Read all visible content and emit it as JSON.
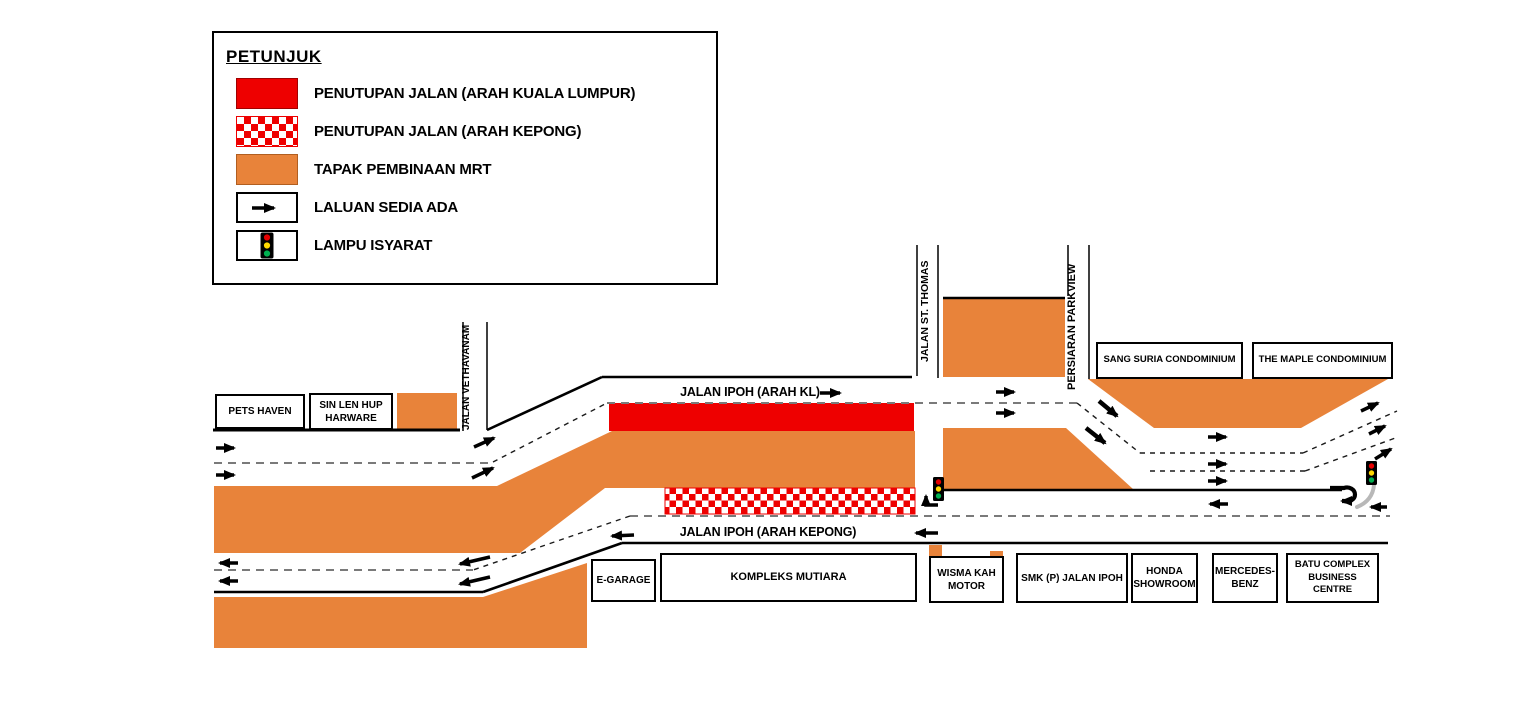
{
  "legend": {
    "title": "PETUNJUK",
    "items": [
      {
        "icon": "solid-red-swatch",
        "label": "PENUTUPAN JALAN (ARAH KUALA LUMPUR)"
      },
      {
        "icon": "checkered-red-swatch",
        "label": "PENUTUPAN JALAN (ARAH KEPONG)"
      },
      {
        "icon": "orange-swatch",
        "label": "TAPAK PEMBINAAN MRT"
      },
      {
        "icon": "arrow-swatch",
        "label": "LALUAN SEDIA ADA"
      },
      {
        "icon": "traffic-light-swatch",
        "label": "LAMPU ISYARAT"
      }
    ]
  },
  "roads": {
    "jalan_ipoh_kl": "JALAN IPOH (ARAH KL)",
    "jalan_ipoh_kepong": "JALAN IPOH (ARAH KEPONG)",
    "jalan_vethavanam": "JALAN VETHAVANAM",
    "jalan_st_thomas": "JALAN ST. THOMAS",
    "persiaran_parkview": "PERSIARAN PARKVIEW"
  },
  "buildings": {
    "pets_haven": "PETS HAVEN",
    "sin_len_hup": "SIN LEN HUP HARWARE",
    "e_garage": "E-GARAGE",
    "kompleks_mutiara": "KOMPLEKS MUTIARA",
    "wisma_kah_motor": "WISMA KAH MOTOR",
    "smk_jalan_ipoh": "SMK (P) JALAN IPOH",
    "honda": "HONDA SHOWROOM",
    "mercedes": "MERCEDES-BENZ",
    "batu_complex": "BATU COMPLEX BUSINESS CENTRE",
    "sang_suria": "SANG SURIA CONDOMINIUM",
    "maple": "THE MAPLE CONDOMINIUM"
  },
  "colors": {
    "closure_red": "#EE0000",
    "mrt_orange": "#E8833A",
    "light_red": "#E60000",
    "light_yellow": "#FFD800",
    "light_green": "#00B050"
  }
}
